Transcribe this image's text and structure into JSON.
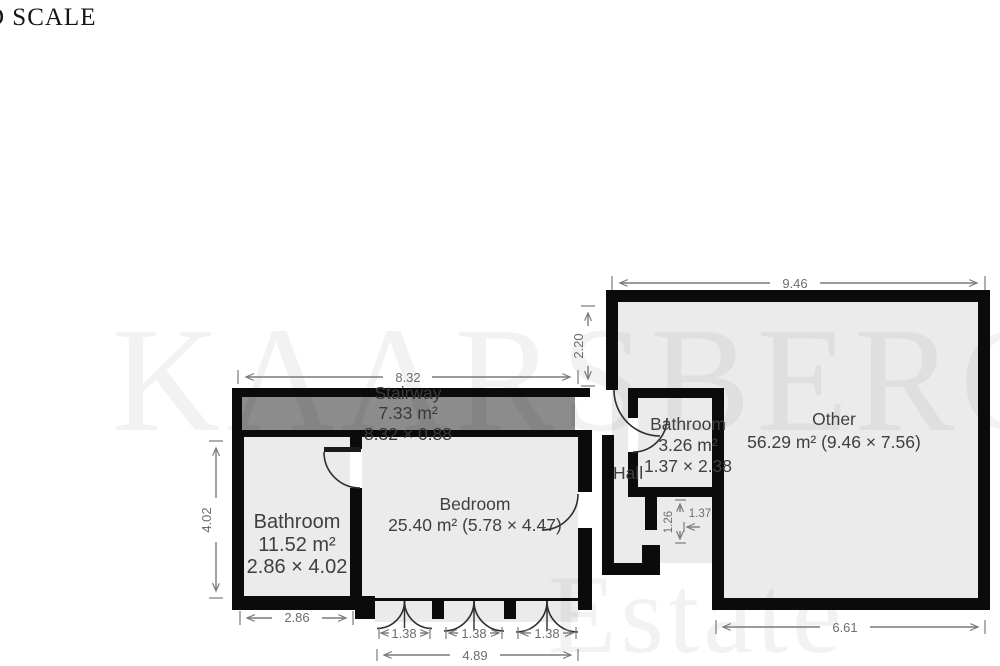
{
  "header": {
    "scale_note": "D SCALE"
  },
  "watermark": {
    "line1": "KAARSBERG",
    "line2": "Estate"
  },
  "rooms": {
    "stairway": {
      "name": "Stairway",
      "area": "7.33 m²",
      "dims": "8.32 × 0.88"
    },
    "bathroom_left": {
      "name": "Bathroom",
      "area": "11.52 m²",
      "dims": "2.86 × 4.02"
    },
    "bedroom": {
      "name": "Bedroom",
      "area_dims": "25.40 m² (5.78 × 4.47)"
    },
    "bathroom_small": {
      "name": "Bathroom",
      "area": "3.26 m²",
      "dims": "1.37 × 2.38"
    },
    "hall": {
      "name": "Hall"
    },
    "other": {
      "name": "Other",
      "area_dims": "56.29 m² (9.46 × 7.56)"
    }
  },
  "dimensions": {
    "stairway_width": "8.32",
    "other_top": "9.46",
    "other_left": "2.20",
    "bath_left_height": "4.02",
    "bath_left_width": "2.86",
    "door_1": "1.38",
    "door_2": "1.38",
    "door_3": "1.38",
    "doors_total": "4.89",
    "other_bottom": "6.61",
    "nook_height": "1.26",
    "nook_width": "1.37"
  },
  "colors": {
    "wall": "#0b0b0b",
    "room_fill": "#ebebeb",
    "stair_fill": "#8c8c8c",
    "dimension": "#7a7a7a"
  }
}
